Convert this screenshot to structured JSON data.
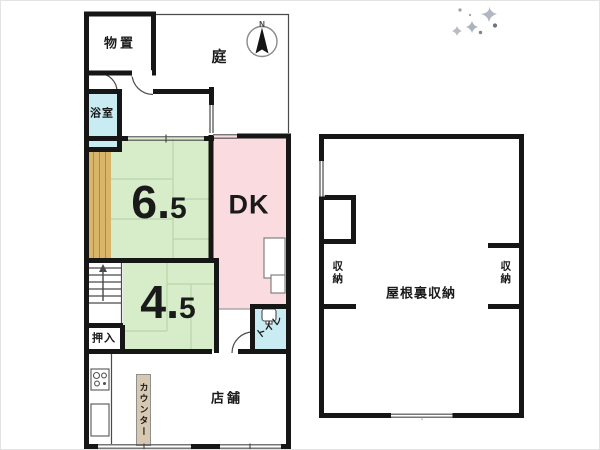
{
  "first_floor": {
    "storage_shed": {
      "label": "物置"
    },
    "garden": {
      "label": "庭"
    },
    "compass": {
      "label": "N"
    },
    "bathroom": {
      "label": "浴室"
    },
    "tatami_room_6_5": {
      "label": "6.5"
    },
    "dining_kitchen": {
      "label": "DK"
    },
    "tatami_room_4_5": {
      "label": "4.5"
    },
    "oshiire_closet": {
      "label": "押入"
    },
    "toilet": {
      "label": "トイレ"
    },
    "counter": {
      "label": "カウンター"
    },
    "shop": {
      "label": "店舗"
    }
  },
  "attic_floor": {
    "closet_left": {
      "label": "収納"
    },
    "attic_storage": {
      "label": "屋根裏収納"
    },
    "closet_right": {
      "label": "収納"
    }
  },
  "palette": {
    "wall": "#161616",
    "tatami_green": "#d7edc9",
    "dk_pink": "#fadce0",
    "water_cyan": "#c8ecf2",
    "wood_tan": "#d9b56a",
    "counter_tan": "#d7c9b1",
    "sparkle_gray": "#98a0ac"
  }
}
